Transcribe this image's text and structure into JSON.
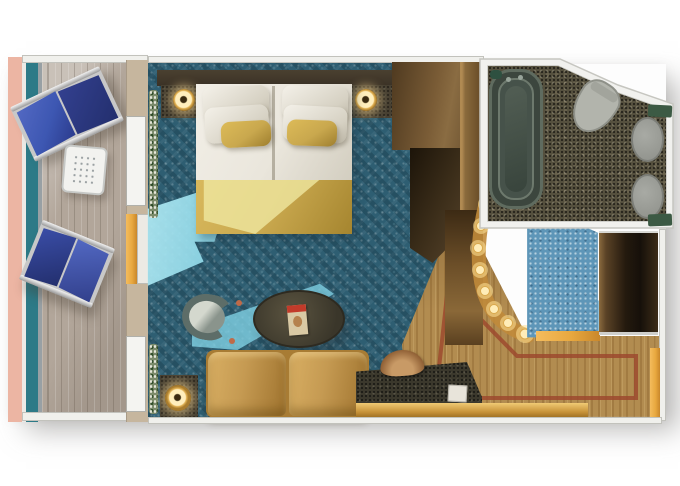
{
  "scene": {
    "type": "floorplan-render",
    "subject": "Cruise ship balcony stateroom, top-down 3D rendered floor plan",
    "width_px": 680,
    "height_px": 486,
    "visible_text": ""
  },
  "palette": {
    "background": "#ffffff",
    "balcony_trim": "#ecb5a3",
    "railing_teal": "#2d7a87",
    "deck_wood": "#b2a69a",
    "carpet_teal": "#2e5e72",
    "carpet_light": "#5e96b8",
    "sunlight_cyan": "#7fd0e2",
    "bed_linen": "#eae6dc",
    "gold_accent": "#c9a84e",
    "sofa_leather": "#c59a52",
    "wall_white": "#f0f0ec",
    "headboard_brown": "#3b3226",
    "wood_floor": "#b28c50",
    "inlay_red": "#9c4a2e",
    "granite_dark": "#55503e",
    "fixture_gray": "#9b9d99",
    "door_amber": "#e8a83f",
    "lamp_glow": "#ffedb8",
    "lounger_blue": "#3d57b2",
    "lounger_blue_dark": "#232f6e",
    "tub_green": "#3c463e",
    "plant_green": "#5a7046"
  },
  "areas": {
    "balcony": {
      "name": "private balcony",
      "furniture": [
        "lounge-chair-upper",
        "lounge-chair-lower",
        "perforated-side-table"
      ]
    },
    "stateroom": {
      "name": "bedroom / sitting area",
      "furniture": [
        "king-bed",
        "nightstand-left",
        "nightstand-right",
        "table-lamp-left",
        "table-lamp-right",
        "tub-chair",
        "oval-coffee-table",
        "magazine",
        "leather-sofa",
        "side-table-lamp",
        "granite-desk",
        "desk-tray",
        "note-card",
        "wardrobe",
        "plants"
      ]
    },
    "corridor": {
      "name": "entry corridor",
      "furniture": [
        "vanity-counter",
        "vanity-light-strip",
        "closet"
      ]
    },
    "bathroom": {
      "name": "bathroom",
      "furniture": [
        "bathtub",
        "toilet",
        "sink-upper",
        "sink-lower",
        "towel-upper",
        "towel-lower"
      ]
    },
    "foyer": {
      "name": "entry foyer",
      "furniture": [
        "wood-floor-inlay",
        "entry-door"
      ]
    }
  }
}
